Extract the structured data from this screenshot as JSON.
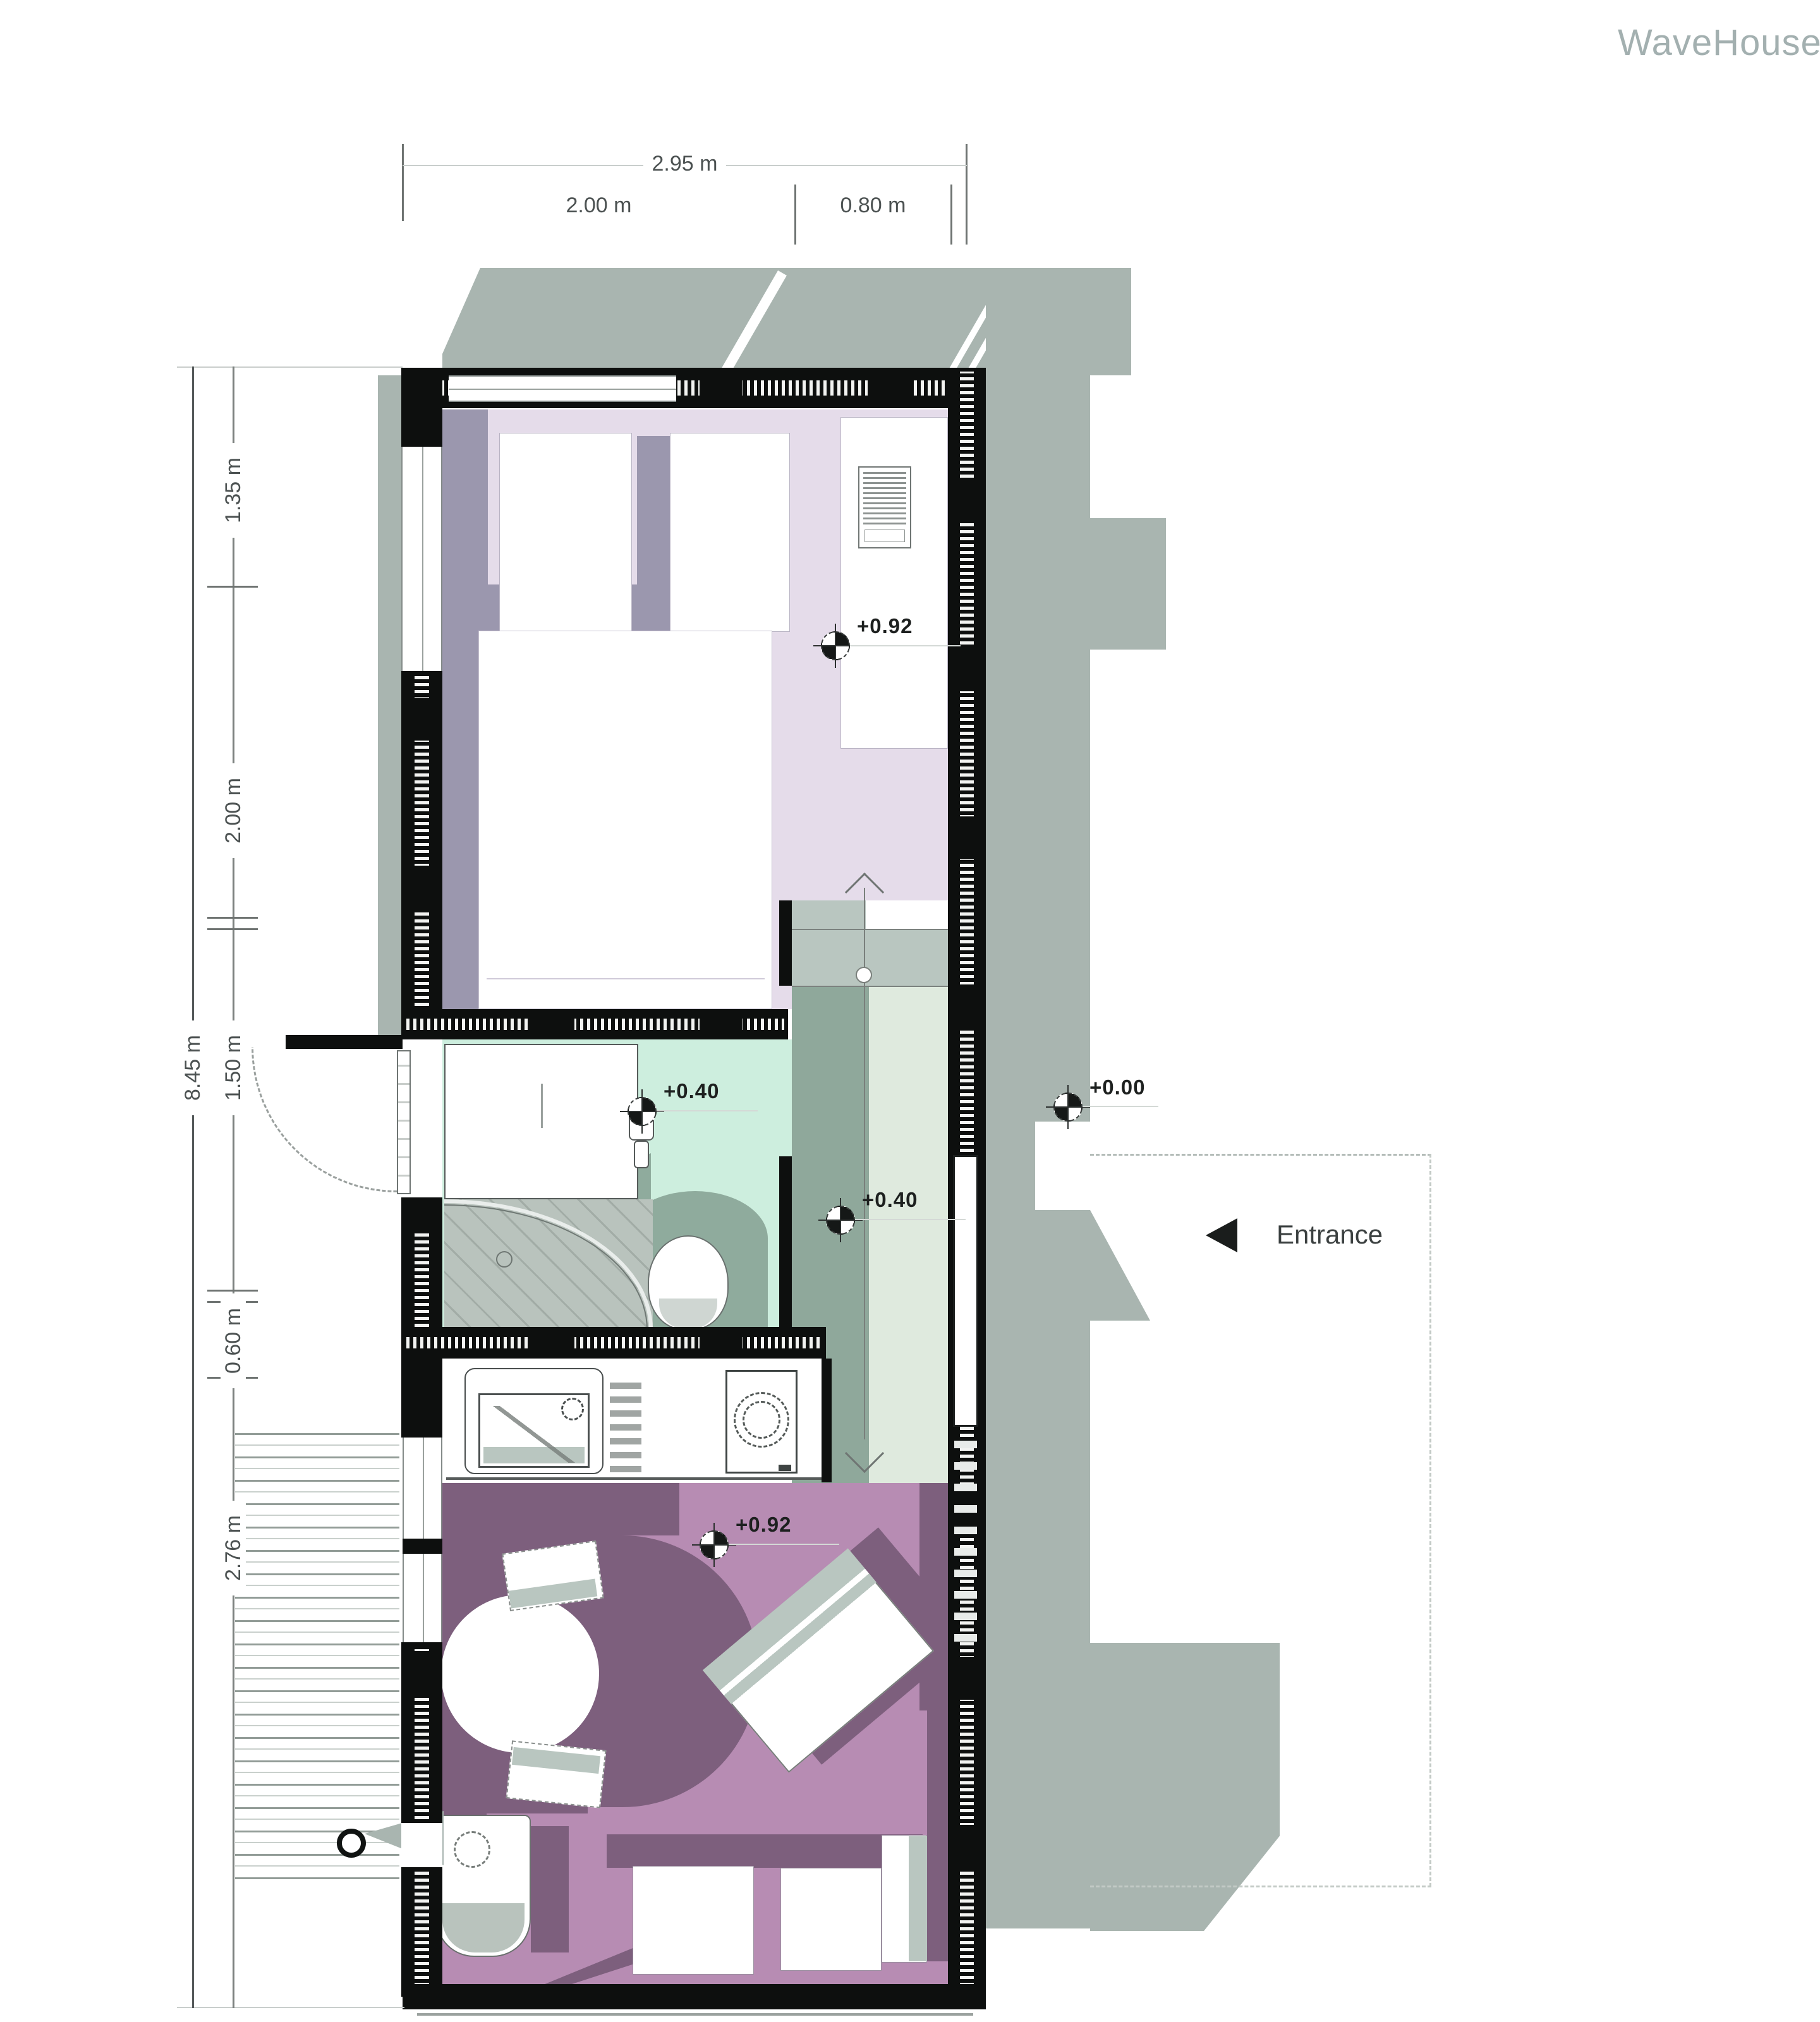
{
  "brand": {
    "logo": "WaveHouse"
  },
  "dimensions": {
    "top": {
      "overall": "2.95 m",
      "seg1": "2.00 m",
      "seg2": "0.80 m"
    },
    "left": {
      "overall": "8.45 m",
      "seg1": "1.35 m",
      "seg2": "2.00 m",
      "seg3": "1.50 m",
      "seg4": "0.60 m",
      "seg5": "2.76 m"
    }
  },
  "levels": {
    "bedroom": "+0.92",
    "bathroom": "+0.40",
    "hall": "+0.40",
    "exterior": "+0.00",
    "living": "+0.92"
  },
  "annotations": {
    "entrance": "Entrance"
  },
  "colors": {
    "wall": "#0d0f0e",
    "bedroom_floor": "#e5dcea",
    "bathroom_floor": "#cdeede",
    "hall_dark": "#8fa89b",
    "hall_light": "#dfeade",
    "living_floor": "#b78cb3",
    "shadow_violet": "#9b97ae",
    "shadow_plum": "#7d5f7d",
    "exterior_shadow": "#a9b5b0"
  }
}
